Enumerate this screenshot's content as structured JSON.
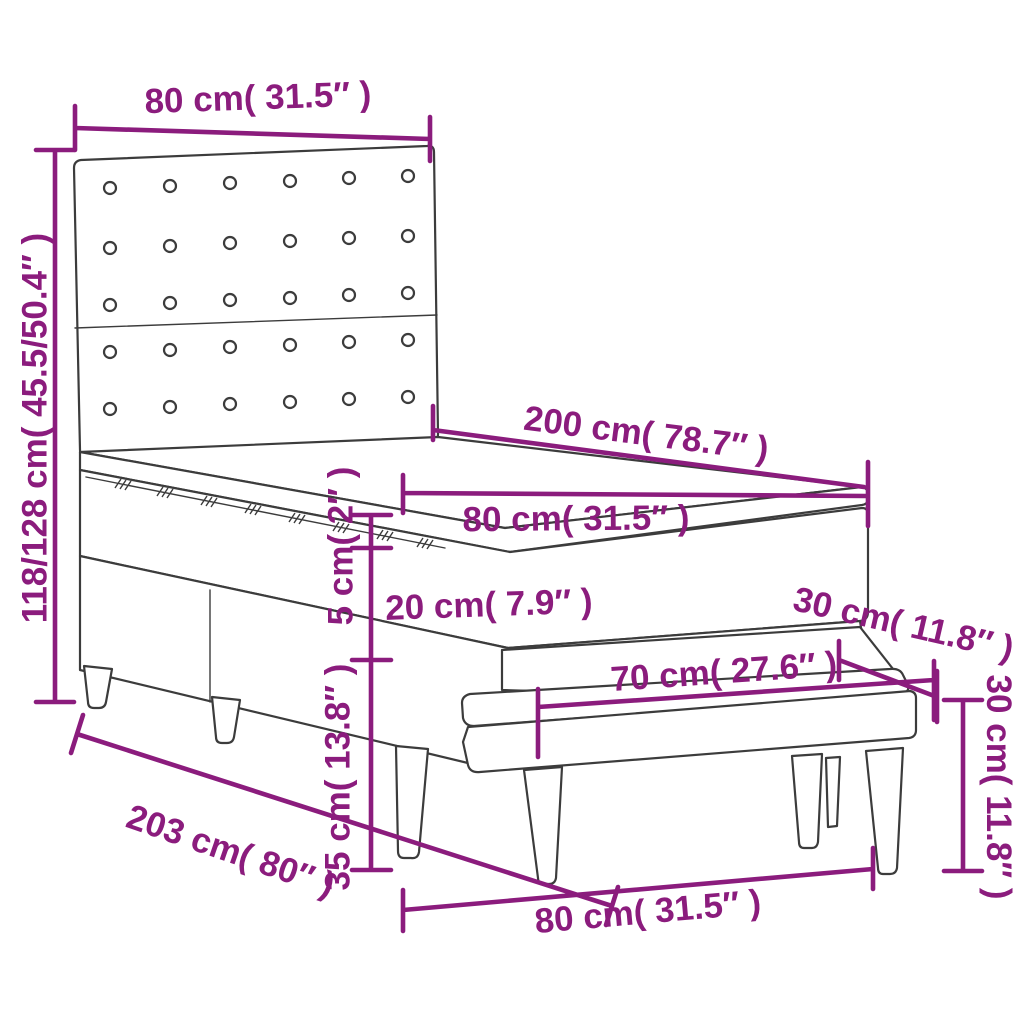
{
  "colors": {
    "dimension_accent": "#8B1C7D",
    "line_art": "#3C3C3C",
    "background": "#FFFFFF"
  },
  "labels": {
    "headboard_width": "80 cm( 31.5″ )",
    "bed_height_range": "118/128 cm( 45.5/50.4″ )",
    "mattress_length": "200 cm( 78.7″ )",
    "mattress_width": "80 cm( 31.5″ )",
    "topper_thickness": "5 cm( 2″ )",
    "mattress_thickness": "20 cm( 7.9″ )",
    "base_with_legs_height": "35 cm( 13.8″ )",
    "bed_total_length": "203 cm( 80″ )",
    "bench_seat_length": "70 cm( 27.6″ )",
    "bench_seat_depth": "30 cm( 11.8″ )",
    "bench_height": "30 cm( 11.8″ )",
    "bench_length_floor": "80 cm( 31.5″ )"
  }
}
